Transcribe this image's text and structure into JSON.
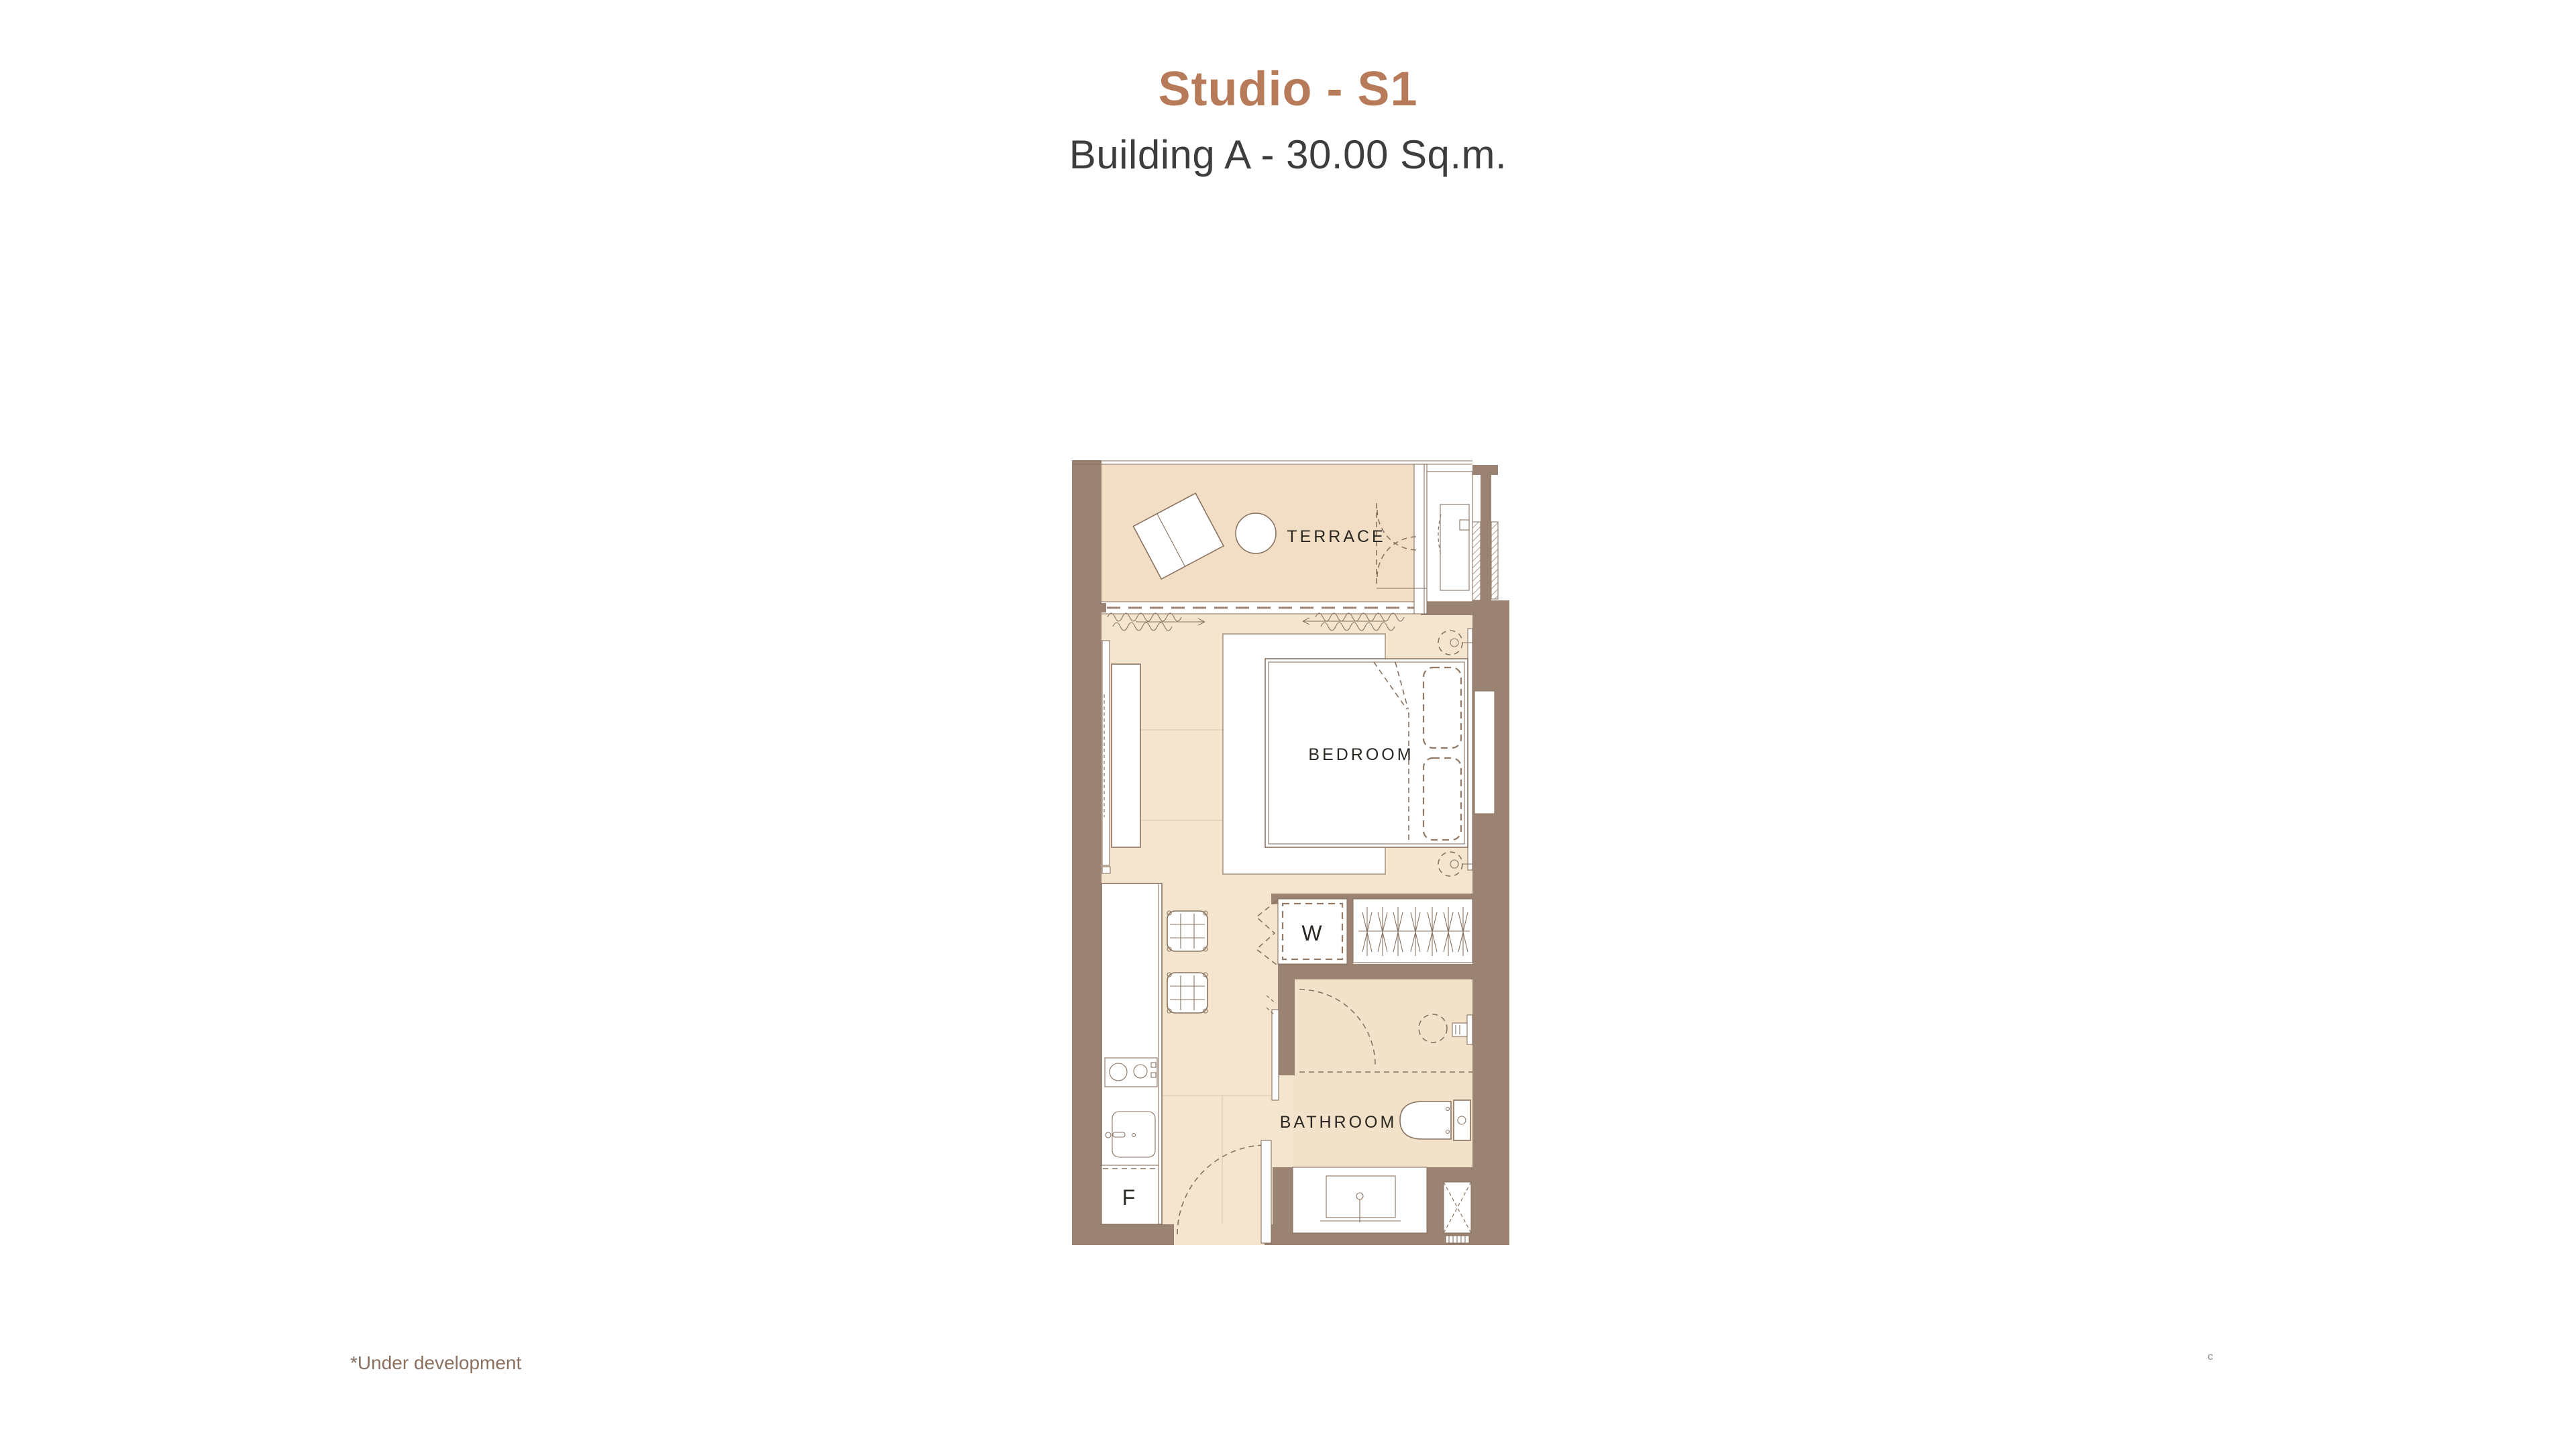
{
  "header": {
    "title": "Studio - S1",
    "subtitle": "Building A - 30.00 Sq.m."
  },
  "plan": {
    "labels": {
      "terrace": "TERRACE",
      "bedroom": "BEDROOM",
      "bathroom": "BATHROOM",
      "washer": "W",
      "fridge": "F"
    }
  },
  "footnote": "*Under development",
  "artifact": "c",
  "colors": {
    "accent": "#b87b59",
    "subtitle_text": "#3d3d3d",
    "wall": "#9b8373",
    "floor": "#f4e5ce",
    "terrace_floor": "#f1dec4",
    "bathroom_floor": "#f2e2c9",
    "line": "#8a7260",
    "label_text": "#2b2722",
    "footnote_text": "#8a7060",
    "page_bg": "#ffffff"
  }
}
